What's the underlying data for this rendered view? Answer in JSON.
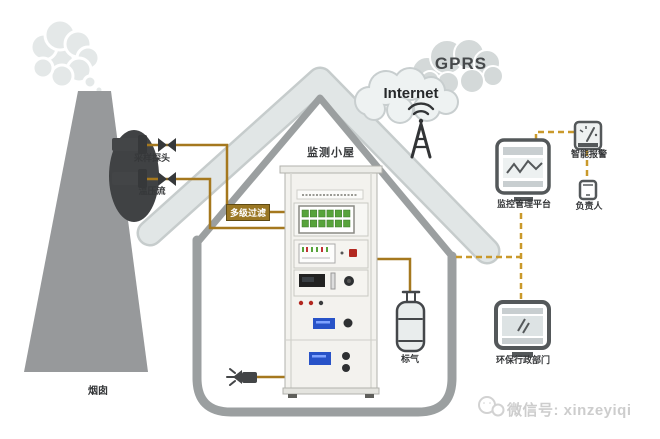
{
  "labels": {
    "chimney": "烟囱",
    "probe_top": "采样探头",
    "probe_bottom": "温压流",
    "filter": "多级过滤",
    "house": "监测小屋",
    "gprs": "GPRS",
    "internet": "Internet",
    "gas": "标气",
    "platform": "监控管理平台",
    "alarm": "智能报警",
    "person": "负责人",
    "epa": "环保行政部门",
    "watermark": "微信号: xinzeyiqi"
  },
  "colors": {
    "solid_line": "#a5781e",
    "dashed_line": "#c9992b",
    "filter_box_bg": "#9a7724",
    "filter_box_border": "#5f4a12",
    "structure_gray": "#9b9fa0",
    "roof_light": "#e1e6e6",
    "icon_stroke": "#54585a",
    "dark_part": "#3f4143",
    "chimney_gray": "#97999b",
    "smoke_gray": "#e4e8e8",
    "green_indicator": "#57a33b",
    "lcd_blue": "#2853c8",
    "red_accent": "#b22820",
    "watermark_gray": "#cdcdcd"
  }
}
